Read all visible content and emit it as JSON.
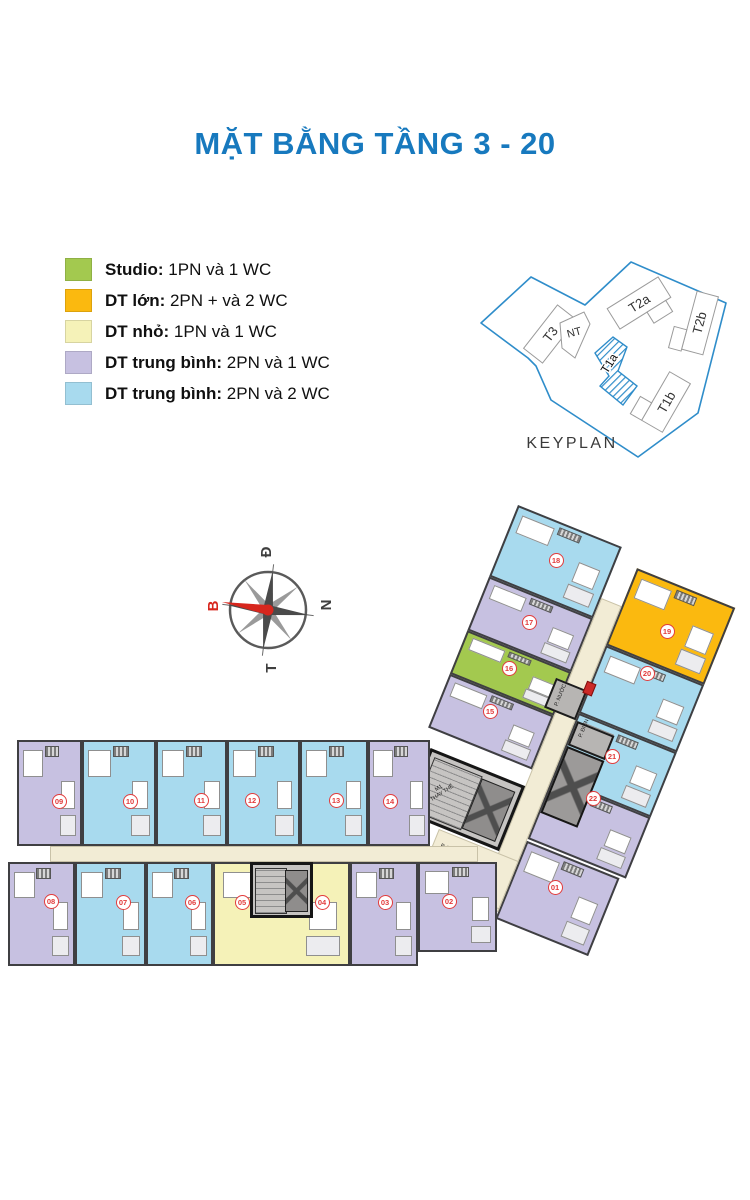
{
  "title": "MẶT BẰNG TẦNG 3 - 20",
  "legend": [
    {
      "key": "studio",
      "color": "#a3c94f",
      "label": "Studio:",
      "desc": " 1PN và 1 WC"
    },
    {
      "key": "large",
      "color": "#fbb90f",
      "label": "DT lớn:",
      "desc": " 2PN + và 2 WC"
    },
    {
      "key": "small",
      "color": "#f5f2b8",
      "label": "DT nhỏ:",
      "desc": " 1PN  và 1 WC"
    },
    {
      "key": "medium1",
      "color": "#c7c1e1",
      "label": "DT trung bình:",
      "desc": " 2PN và 1 WC"
    },
    {
      "key": "medium2",
      "color": "#a8daee",
      "label": "DT trung bình:",
      "desc": " 2PN và 2 WC"
    }
  ],
  "type_colors": {
    "studio": "#a3c94f",
    "large": "#fbb90f",
    "small": "#f5f2b8",
    "medium1": "#c7c1e1",
    "medium2": "#a8daee"
  },
  "keyplan": {
    "caption": "KEYPLAN",
    "highlight": "T1a",
    "blocks": [
      "T3",
      "NT",
      "T2a",
      "T1a",
      "T2b",
      "T1b"
    ]
  },
  "compass": {
    "top": "Đ",
    "right": "N",
    "bottom": "T",
    "left": "B"
  },
  "plan": {
    "units": [
      {
        "id": "01",
        "type": "medium1"
      },
      {
        "id": "02",
        "type": "medium1"
      },
      {
        "id": "03",
        "type": "medium1"
      },
      {
        "id": "04",
        "type": "small"
      },
      {
        "id": "05",
        "type": "small"
      },
      {
        "id": "06",
        "type": "medium2"
      },
      {
        "id": "07",
        "type": "medium2"
      },
      {
        "id": "08",
        "type": "medium1"
      },
      {
        "id": "09",
        "type": "medium1"
      },
      {
        "id": "10",
        "type": "medium2"
      },
      {
        "id": "11",
        "type": "medium2"
      },
      {
        "id": "12",
        "type": "medium2"
      },
      {
        "id": "13",
        "type": "medium2"
      },
      {
        "id": "14",
        "type": "medium1"
      },
      {
        "id": "15",
        "type": "medium1"
      },
      {
        "id": "16",
        "type": "studio"
      },
      {
        "id": "17",
        "type": "medium1"
      },
      {
        "id": "18",
        "type": "medium2"
      },
      {
        "id": "19",
        "type": "large"
      },
      {
        "id": "20",
        "type": "medium2"
      },
      {
        "id": "21",
        "type": "medium2"
      },
      {
        "id": "22",
        "type": "medium1"
      }
    ],
    "services": {
      "stair_line1": "M1",
      "stair_line2": "THAY THẾ",
      "trash": "P. RÁC",
      "tech": "H.K",
      "electric": "P. ĐIỆN",
      "water": "P. NƯỚC"
    }
  }
}
